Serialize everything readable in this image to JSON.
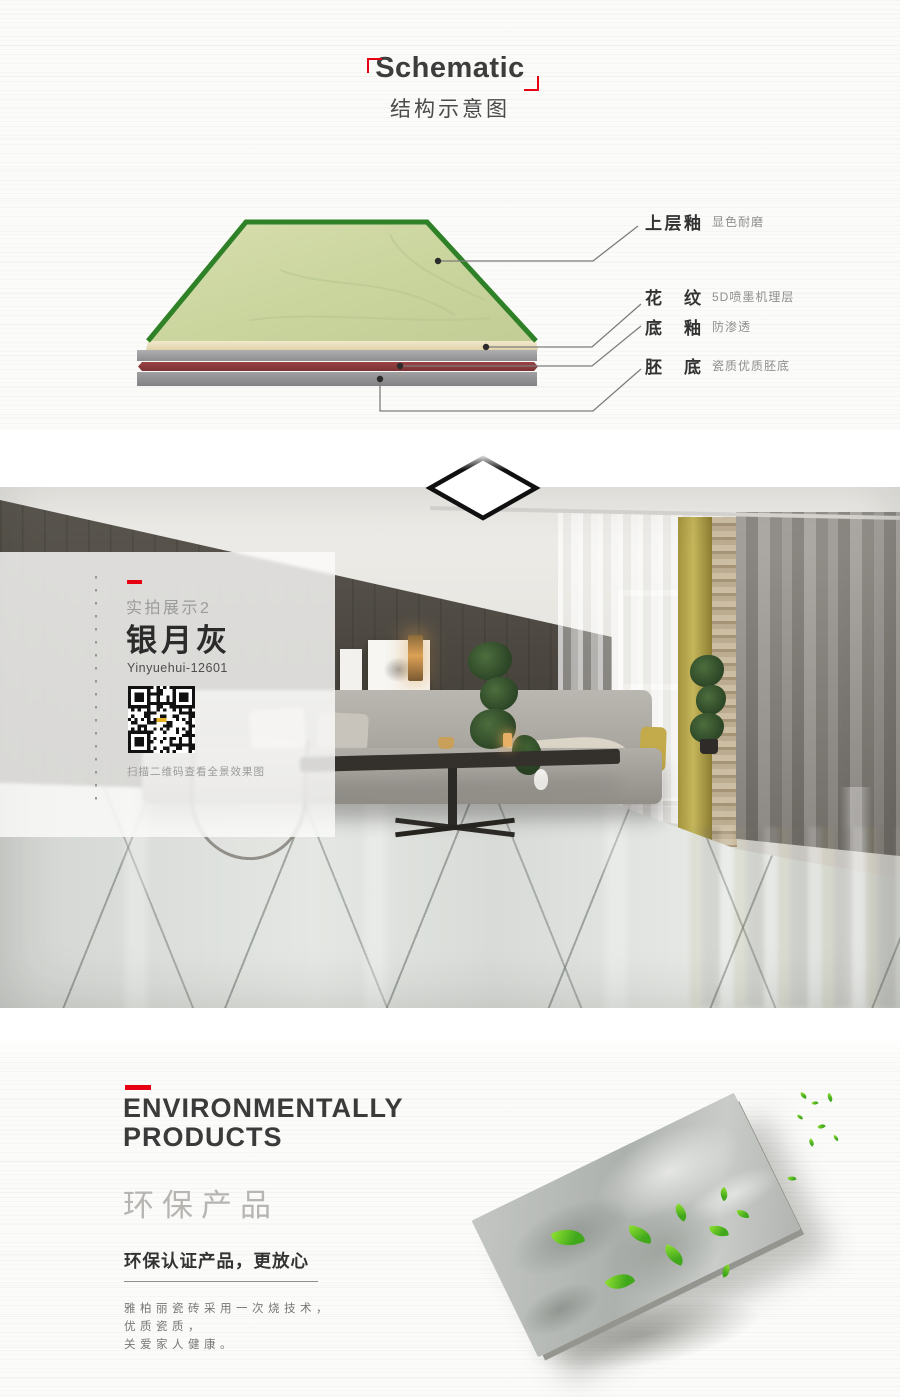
{
  "theme": {
    "accent_red": "#e60012",
    "text_dark": "#3b3b3b",
    "text_gray": "#8f8f8f",
    "tile_green_border": "#2f8128",
    "tile_surface_green": "#cdd7a4",
    "tile_body_red": "#8d3a3b"
  },
  "schematic": {
    "title_en": "Schematic",
    "title_zh": "结构示意图",
    "layers": [
      {
        "name": "上层釉",
        "desc": "显色耐磨"
      },
      {
        "name": "花纹",
        "desc": "5D喷墨机理层"
      },
      {
        "name": "底釉",
        "desc": "防渗透"
      },
      {
        "name": "胚底",
        "desc": "瓷质优质胚底"
      }
    ]
  },
  "showcase": {
    "tag": "实拍展示2",
    "product_name": "银月灰",
    "product_code": "Yinyuehui-12601",
    "qr_icon": "qr-code",
    "qr_caption": "扫描二维码查看全景效果图"
  },
  "eco": {
    "title_line1": "ENVIRONMENTALLY",
    "title_line2": "PRODUCTS",
    "title_zh": "环保产品",
    "subtitle": "环保认证产品，更放心",
    "body_lines": [
      "雅柏丽瓷砖采用一次烧技术，",
      "优质瓷质，",
      "关爱家人健康。"
    ]
  }
}
